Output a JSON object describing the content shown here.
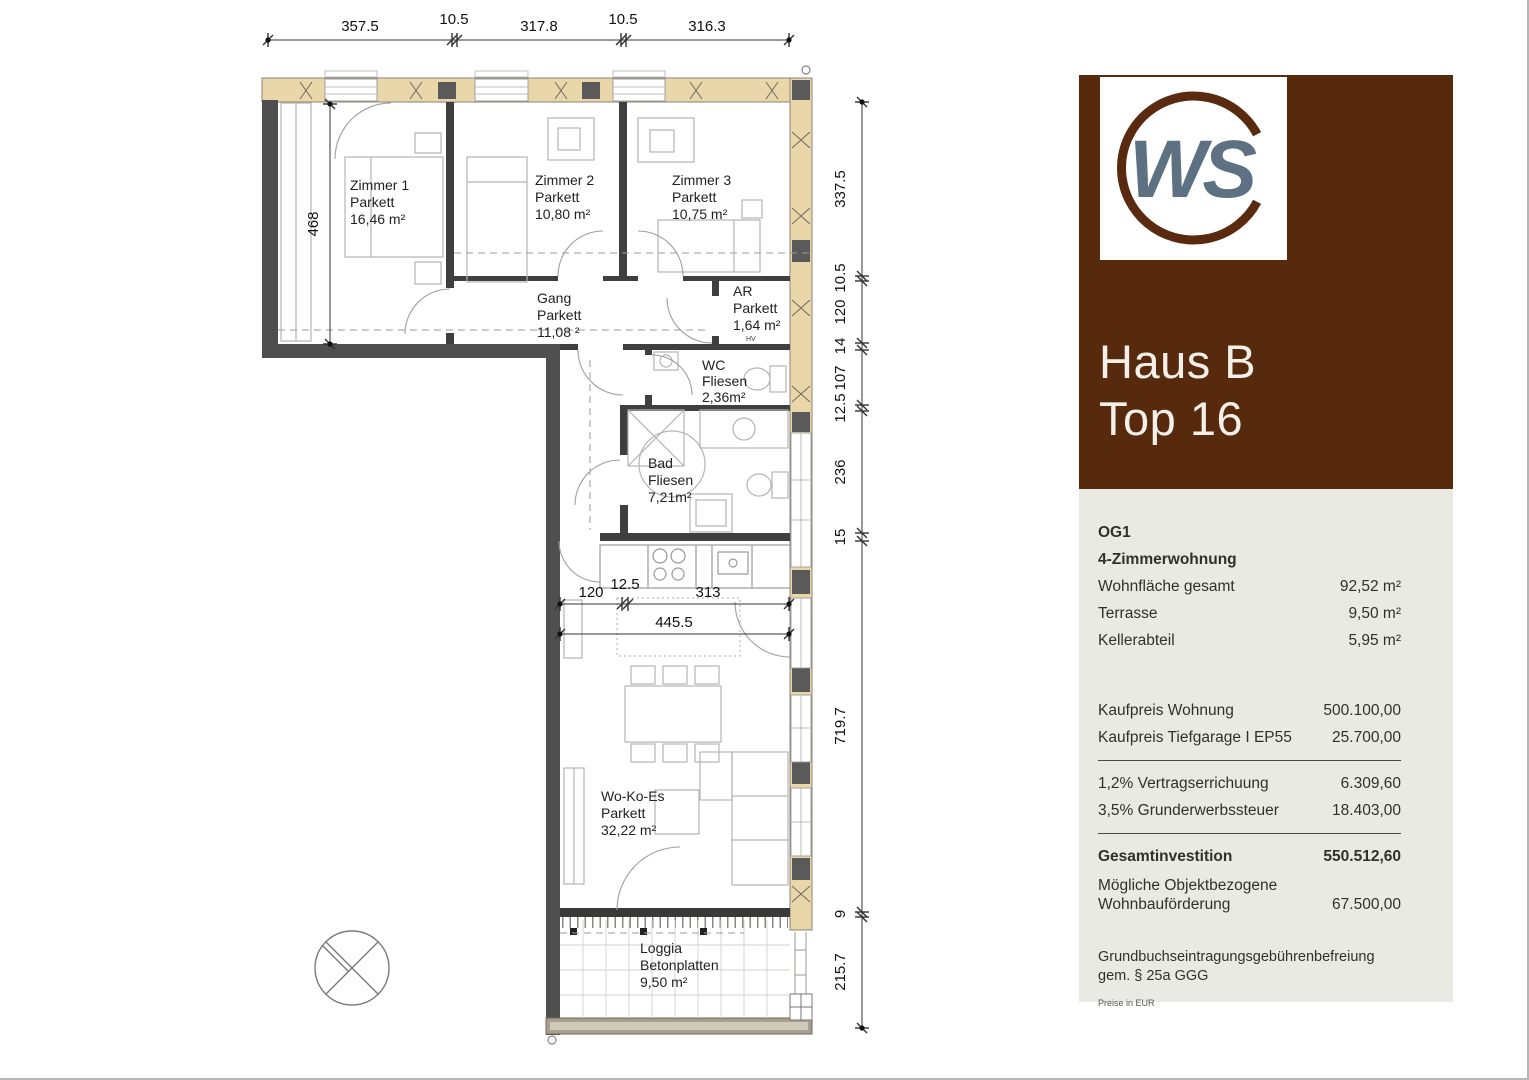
{
  "plan": {
    "rooms": {
      "zimmer1": {
        "name": "Zimmer 1",
        "floor": "Parkett",
        "area": "16,46 m²"
      },
      "zimmer2": {
        "name": "Zimmer 2",
        "floor": "Parkett",
        "area": "10,80 m²"
      },
      "zimmer3": {
        "name": "Zimmer 3",
        "floor": "Parkett",
        "area": "10,75 m²"
      },
      "gang": {
        "name": "Gang",
        "floor": "Parkett",
        "area": "11,08 ²"
      },
      "ar": {
        "name": "AR",
        "floor": "Parkett",
        "area": "1,64 m²"
      },
      "wc": {
        "name": "WC",
        "floor": "Fliesen",
        "area": "2,36m²"
      },
      "bad": {
        "name": "Bad",
        "floor": "Fliesen",
        "area": "7,21m²"
      },
      "wokoes": {
        "name": "Wo-Ko-Es",
        "floor": "Parkett",
        "area": "32,22 m²"
      },
      "loggia": {
        "name": "Loggia",
        "floor": "Betonplatten",
        "area": "9,50 m²"
      }
    },
    "dims": {
      "top": [
        "357.5",
        "10.5",
        "317.8",
        "10.5",
        "316.3"
      ],
      "right": [
        "337.5",
        "10.5",
        "120",
        "14",
        "107",
        "12.5",
        "236",
        "15",
        "719.7",
        "9",
        "215.7"
      ],
      "inner_width": [
        "120",
        "12.5",
        "313"
      ],
      "inner_total": "445.5",
      "left_height": "468"
    },
    "hv_label": "HV"
  },
  "sidebar": {
    "logo_text": "WS",
    "title_line1": "Haus B",
    "title_line2": "Top 16",
    "floor_label": "OG1",
    "type_label": "4-Zimmerwohnung",
    "areas": [
      {
        "label": "Wohnfläche gesamt",
        "value": "92,52 m²"
      },
      {
        "label": "Terrasse",
        "value": "9,50 m²"
      },
      {
        "label": "Kellerabteil",
        "value": "5,95 m²"
      }
    ],
    "prices": [
      {
        "label": "Kaufpreis Wohnung",
        "value": "500.100,00"
      },
      {
        "label": "Kaufpreis Tiefgarage I EP55",
        "value": "25.700,00"
      }
    ],
    "fees": [
      {
        "label": "1,2% Vertragserrichuung",
        "value": "6.309,60"
      },
      {
        "label": "3,5% Grunderwerbssteuer",
        "value": "18.403,00"
      }
    ],
    "total": {
      "label": "Gesamtinvestition",
      "value": "550.512,60"
    },
    "subsidy": {
      "label_line1": "Mögliche Objektbezogene",
      "label_line2": "Wohnbauförderung",
      "value": "67.500,00"
    },
    "note_line1": "Grundbuchseintragungsgebührenbefreiung",
    "note_line2": "gem. § 25a GGG",
    "footnote": "Preise in EUR",
    "colors": {
      "brand_brown": "#572a0d",
      "logo_gray": "#5d7183",
      "panel_bg": "#e9eae3",
      "wall_beige": "#ead7a9",
      "wall_dark": "#4f4f4f"
    }
  }
}
